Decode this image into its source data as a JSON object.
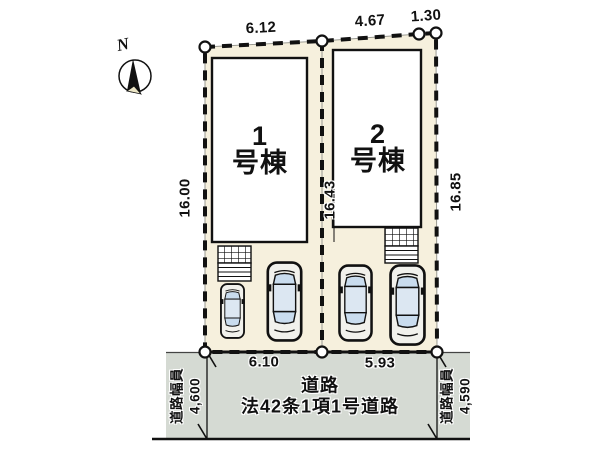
{
  "compass": {
    "north_label": "N"
  },
  "lots": [
    {
      "number": "1",
      "suffix": "号棟"
    },
    {
      "number": "2",
      "suffix": "号棟"
    }
  ],
  "dimensions": {
    "top": [
      "6.12",
      "4.67",
      "1.30"
    ],
    "side_left": "16.00",
    "side_middle": "16.43",
    "side_right": "16.85",
    "frontage": [
      "6.10",
      "5.93"
    ]
  },
  "road": {
    "name": "道路",
    "legal": "法42条1項1号道路",
    "width_label_left": "道路幅員",
    "width_value_left": "4,600",
    "width_label_right": "道路幅員",
    "width_value_right": "4,590"
  },
  "colors": {
    "lot_fill": "#f6f0dd",
    "road_fill": "#d5dad3",
    "building_fill": "#ffffff",
    "glass": "#c9dcee",
    "outline": "#111111"
  }
}
